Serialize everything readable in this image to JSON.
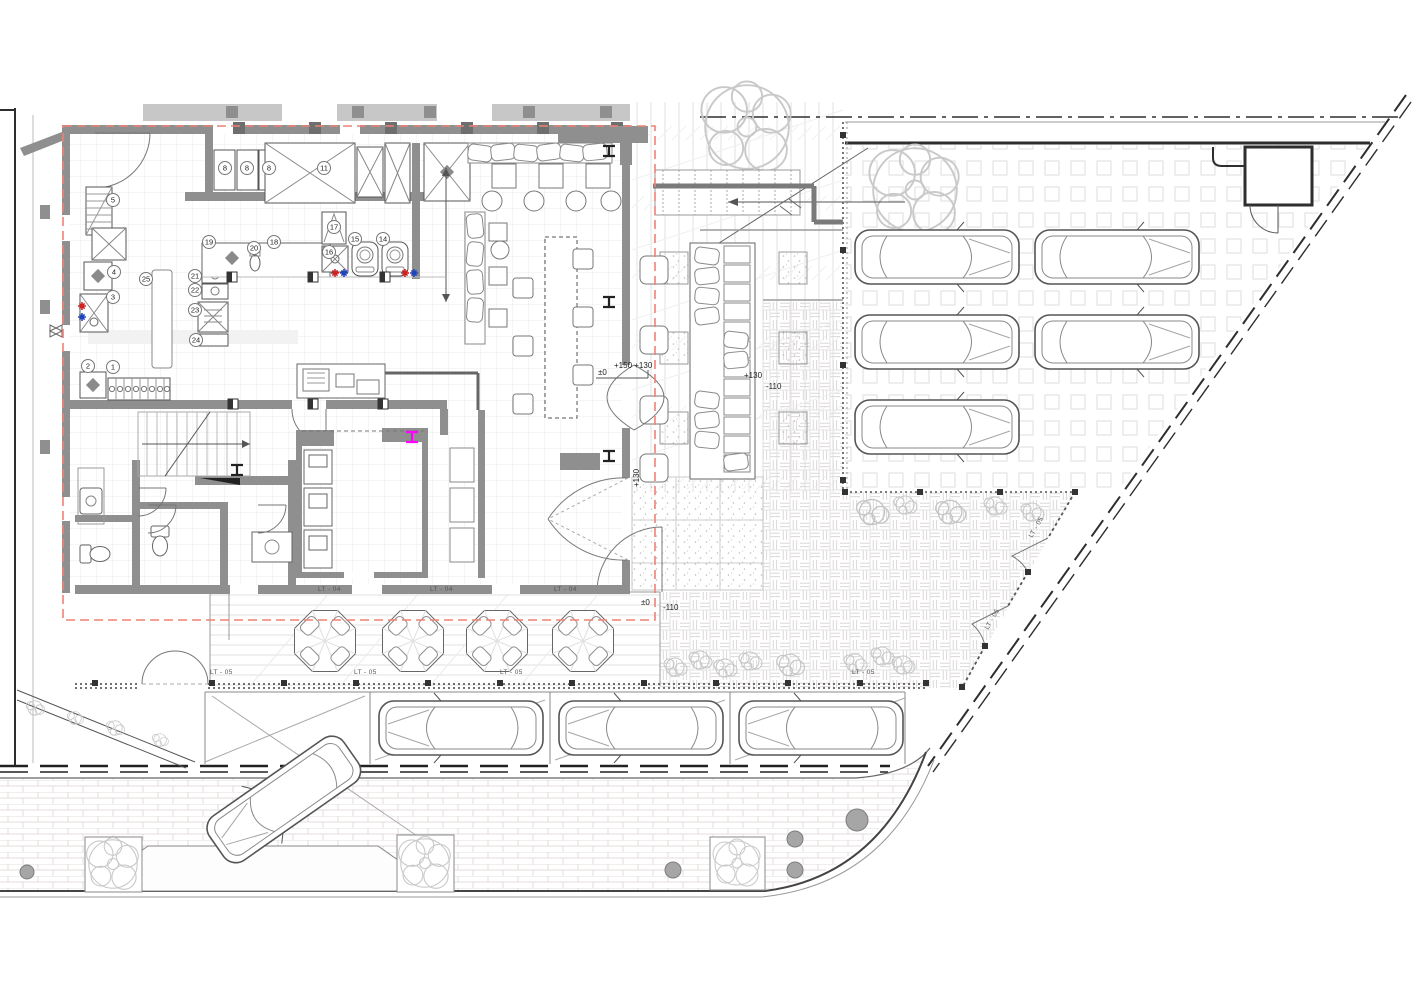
{
  "plan": {
    "levels": {
      "zero": "±0",
      "entry_steps": "+150 +130",
      "terrace": "+130",
      "sunken": "-110"
    },
    "finish_tags": {
      "interior_floor": "LT - 04",
      "exterior_floor": "LT - 05"
    },
    "equipment_numbers": {
      "e1": "1",
      "e2": "2",
      "e3": "3",
      "e4": "4",
      "e5": "5",
      "e8": "8",
      "e11": "11",
      "e14": "14",
      "e15": "15",
      "e16": "16",
      "e17": "17",
      "e18": "18",
      "e19": "19",
      "e20": "20",
      "e21": "21",
      "e22": "22",
      "e23": "23",
      "e24": "24",
      "e25": "25"
    },
    "colors": {
      "setback_line": "#ee8275",
      "wall_fill": "#8f8f8f",
      "dark_line": "#2e2e2e",
      "beam_highlight": "#ff00ff",
      "hot_water": "#cc2222",
      "cold_water": "#2244bb",
      "manhole_fill": "#a6a6a6",
      "pattern_line": "#dddddd"
    },
    "counts": {
      "parking_lot_cars": "5",
      "street_parked_cars": "3",
      "street_turning_cars": "1",
      "terrace_tables": "4",
      "terrace_stools": "4",
      "bar_stools": "6"
    }
  }
}
